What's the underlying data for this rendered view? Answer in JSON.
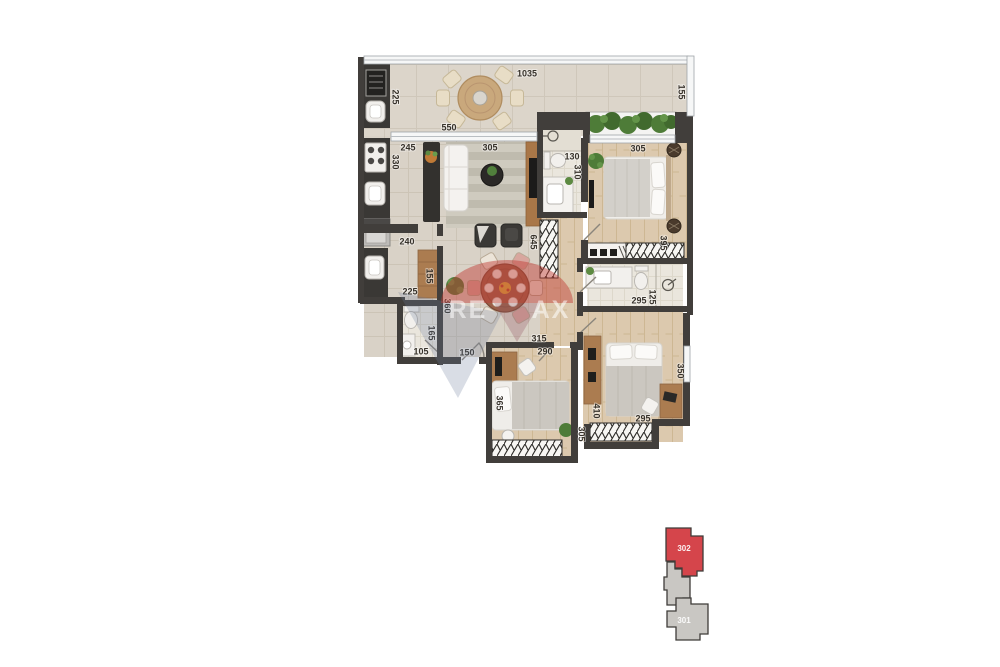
{
  "floor_plan": {
    "dims": {
      "terrace_width": "1035",
      "terrace_depth": "155",
      "grill_balcony_depth": "225",
      "living_window_width": "550",
      "kitchen_width": "245",
      "kitchen_depth": "330",
      "living_width": "305",
      "suite_bath_width": "130",
      "suite_bath_depth": "310",
      "suite_width": "305",
      "suite_depth": "395",
      "living_depth": "645",
      "laundry_width": "240",
      "laundry_cabinet_width": "155",
      "laundry_depth": "225",
      "hall_depth": "360",
      "lavabo_depth": "165",
      "lavabo_width": "105",
      "hall_width": "150",
      "bath_width": "295",
      "bath_depth": "125",
      "bedroom2_top": "315",
      "bedroom2_width": "290",
      "bedroom2_depth": "365",
      "bedroom2_side": "305",
      "bedroom3_depth": "410",
      "bedroom3_width": "295",
      "bedroom3_side": "350"
    },
    "watermark": {
      "brand_left": "RE",
      "brand_right": "AX"
    },
    "colors": {
      "wall": "#413e3b",
      "tile_floor": "#d9d2c7",
      "wood_floor": "#dcc9ae",
      "bath_floor": "#eae6dd",
      "highlight_red": "#d5454b",
      "keyplan_gray": "#c9c7c3",
      "plant_green": "#4e7c38",
      "watermark_red": "#c13e37",
      "watermark_blue": "#6c7d9b"
    }
  },
  "key_plan": {
    "selected_unit": {
      "label": "302"
    },
    "adjacent_unit": {
      "label": "301"
    }
  }
}
